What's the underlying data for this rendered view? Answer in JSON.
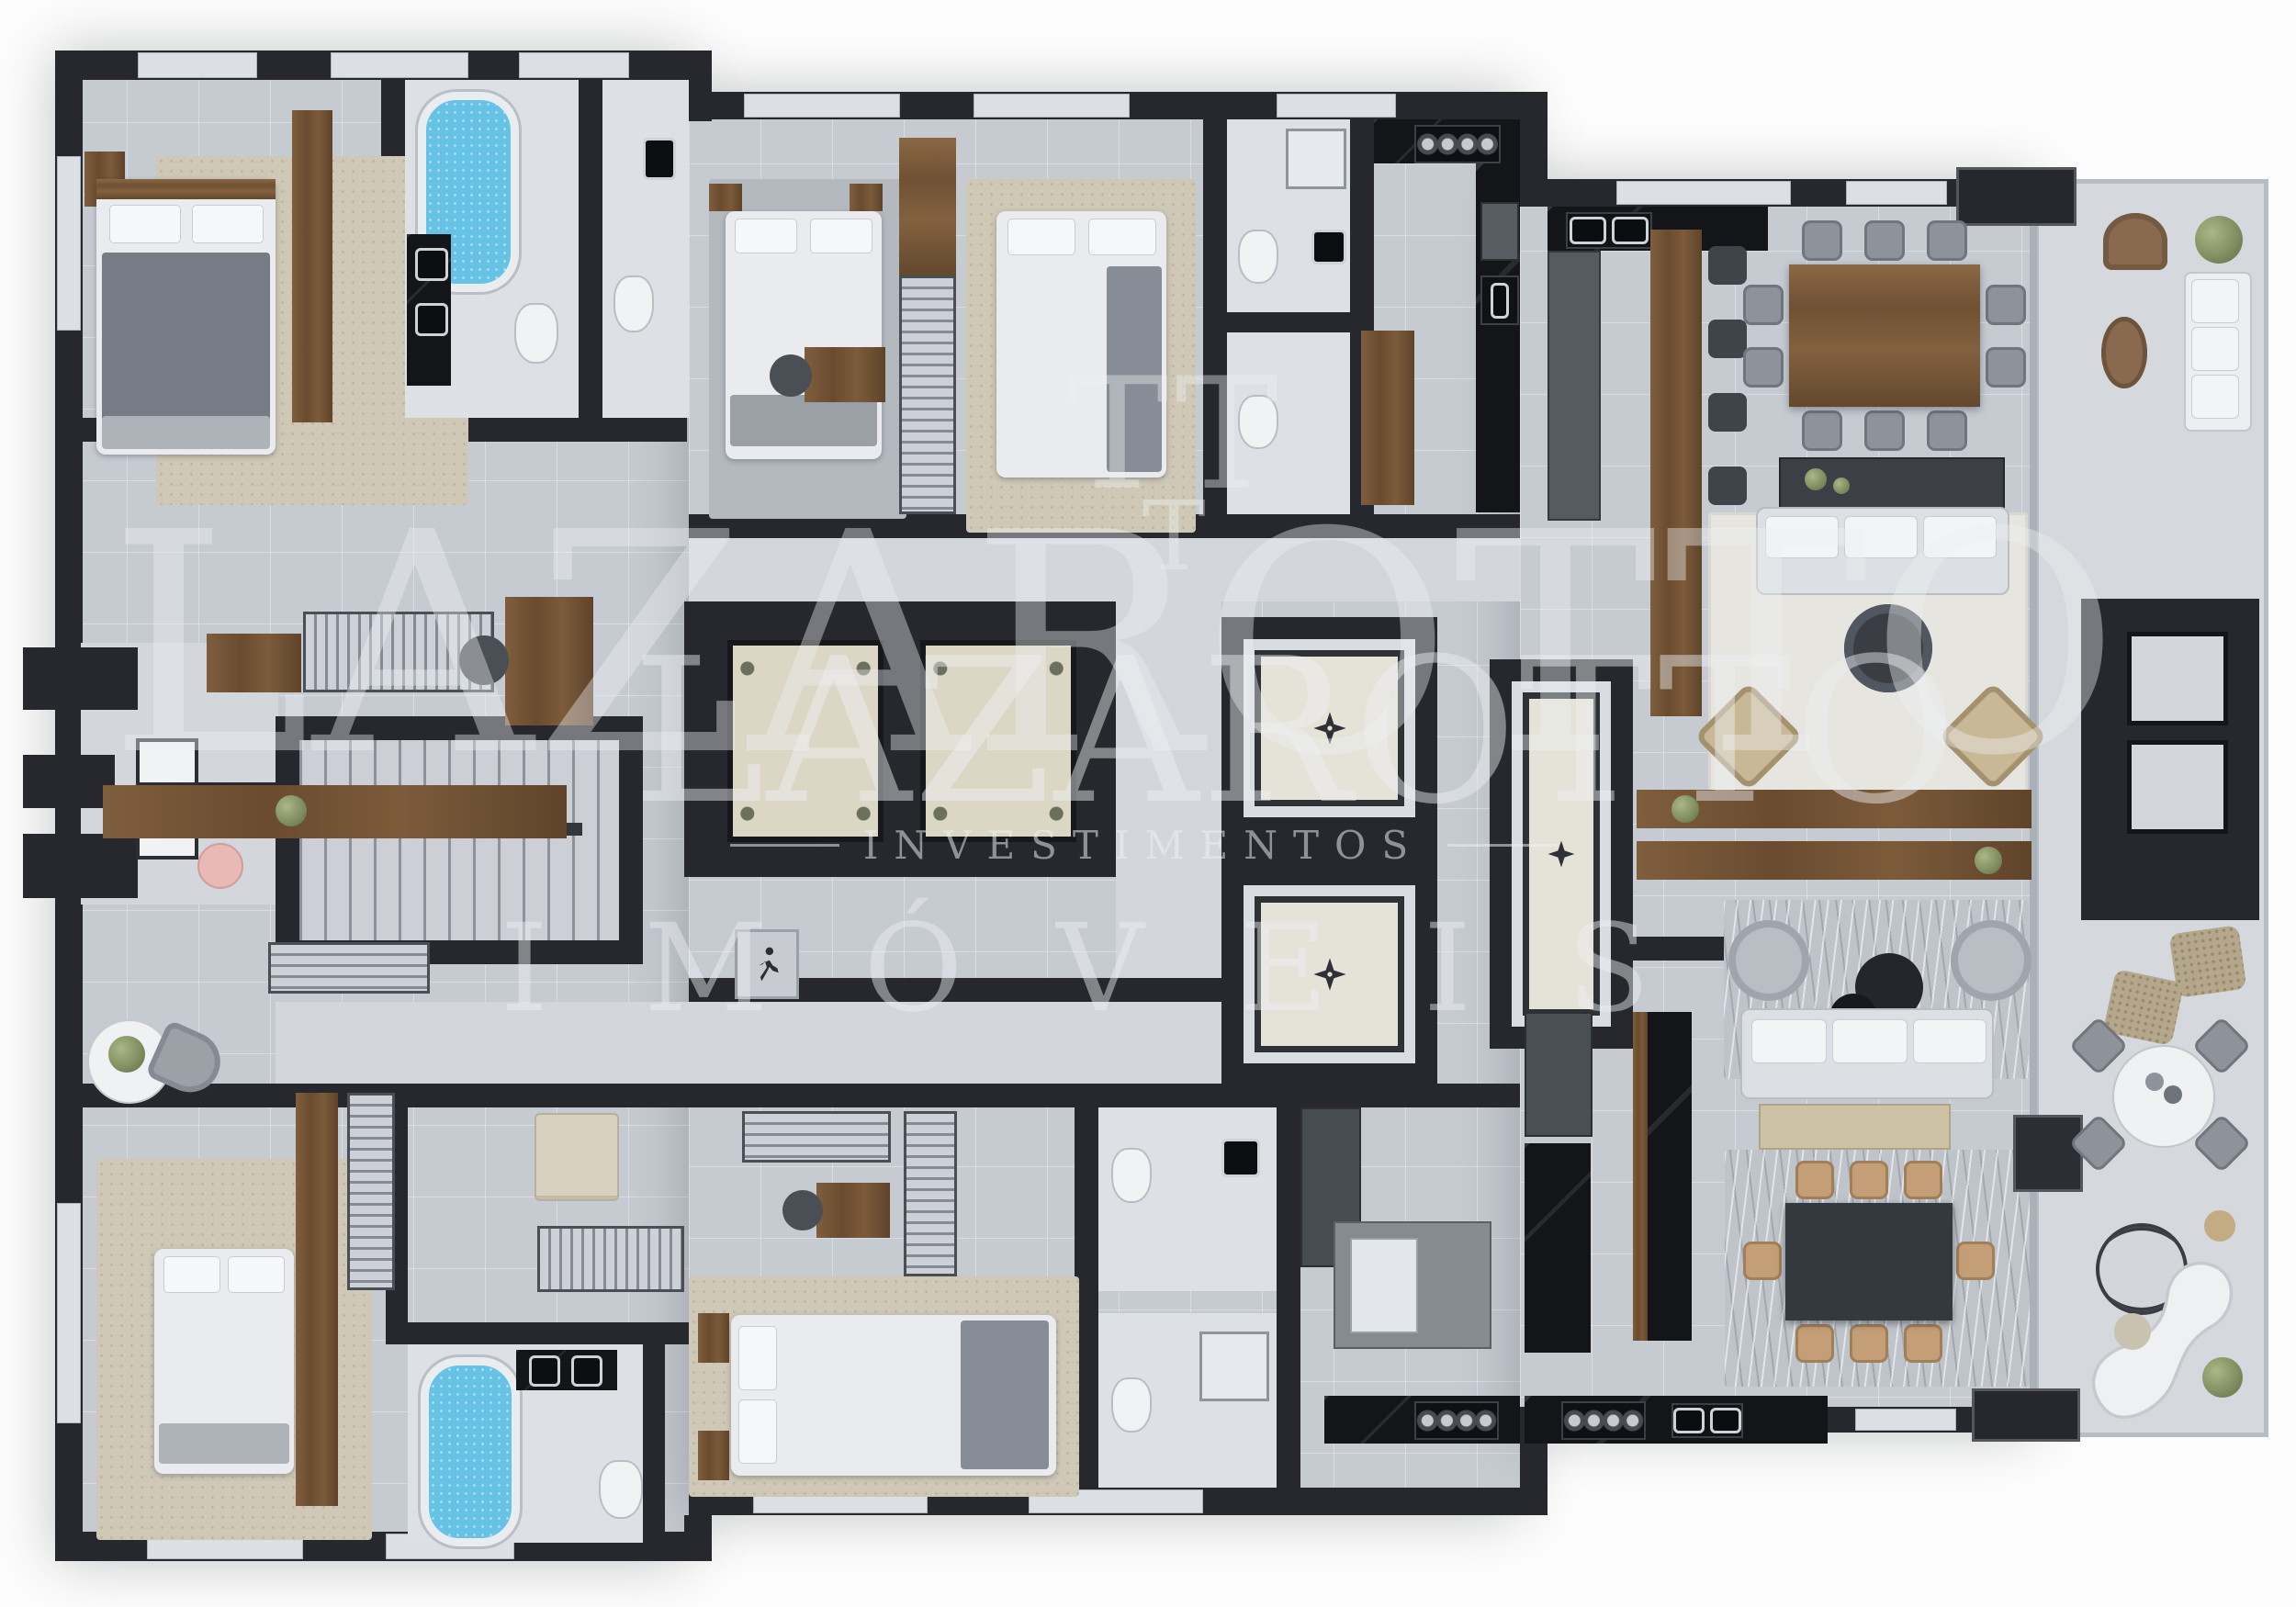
{
  "page": {
    "type": "3d-rendered residential floor plan",
    "background": "#ffffff"
  },
  "watermark": {
    "monogram": "TT",
    "monogram_small": "T",
    "brand_large": "LAZAROTTO",
    "brand_medium": "LAZAROTTO",
    "tagline": "INVESTIMENTOS",
    "category": "IMÓVEIS"
  },
  "palette": {
    "wall": "#26282d",
    "floor_main": "#c6cad1",
    "floor_light": "#d3d7dc",
    "floor_bath": "#dde1e6",
    "floor_balcony": "#d5d8dc",
    "window_marble": "#dce0e4",
    "wood": "#74563a",
    "counter_black_marble": "#141519",
    "water_blue": "#67c3e5",
    "rug_beige": "#cfc8b6",
    "rug_cream": "#e6e5df",
    "rug_gray": "#b4b8bf",
    "furniture_white": "#eceef0",
    "furniture_gray": "#969ba3",
    "elevator_floor": "#dcd6c5",
    "accent_pink": "#e8b9b6",
    "plant_green": "#8a9768",
    "watermark_white": "#eef1f4"
  },
  "icons": [
    {
      "name": "exit-person-icon",
      "meaning": "emergency exit running figure on stair landing"
    },
    {
      "name": "floor-medallion-icon",
      "meaning": "decorative star medallion on foyer floor"
    },
    {
      "name": "stove-burners-icon",
      "meaning": "four-burner gas cooktop"
    }
  ]
}
